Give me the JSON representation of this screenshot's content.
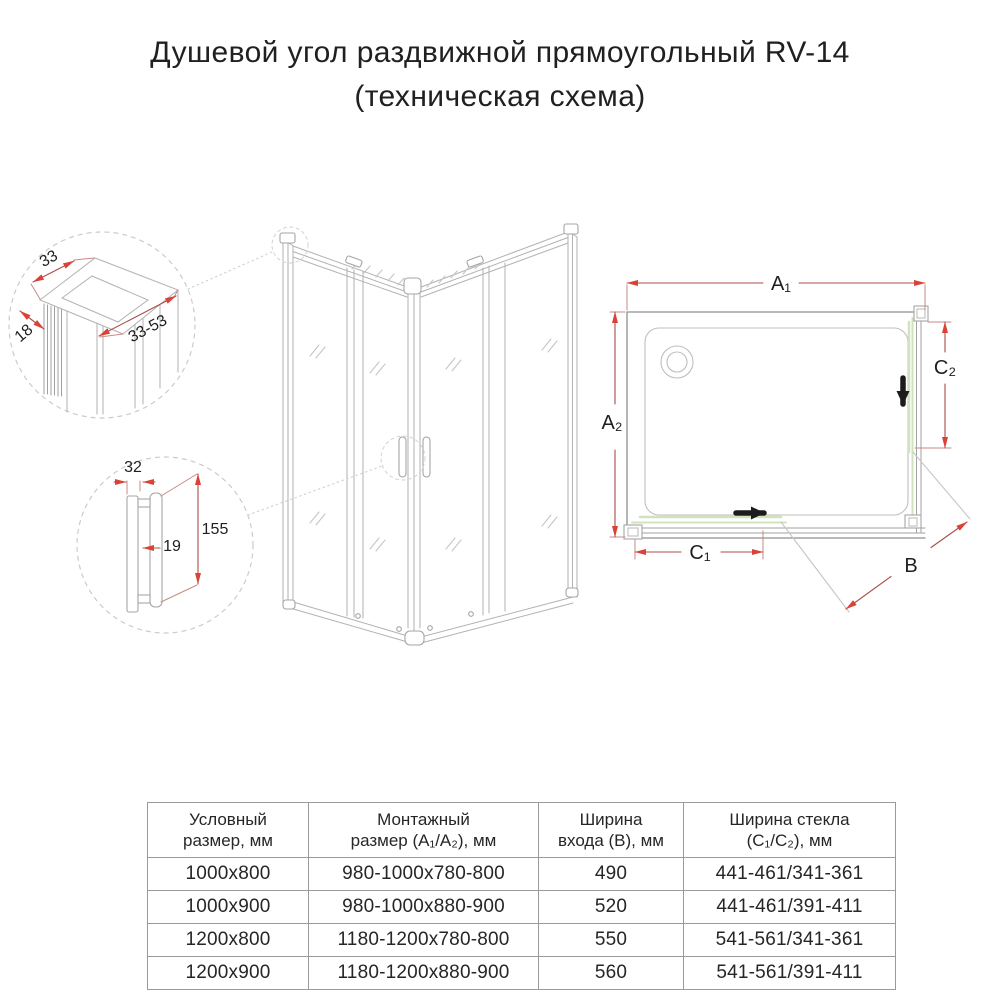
{
  "title": {
    "line1": "Душевой угол раздвижной прямоугольный RV-14",
    "line2": "(техническая схема)"
  },
  "diagram": {
    "profile_detail": {
      "width": "33",
      "depth": "18",
      "range": "33-53"
    },
    "handle_detail": {
      "depth": "32",
      "thickness": "19",
      "height": "155"
    },
    "plan": {
      "a1": "A₁",
      "a2": "A₂",
      "b": "B",
      "c1": "C₁",
      "c2": "C₂"
    },
    "colors": {
      "dimension_line": "#ab4d49",
      "dimension_arrow": "#da4237",
      "glass_green": "#cfe4bd",
      "drawing_gray": "#b2b2b2",
      "direction_arrow": "#1c1c1c"
    }
  },
  "table": {
    "headers": [
      {
        "line1": "Условный",
        "line2": "размер, мм"
      },
      {
        "line1": "Монтажный",
        "line2": "размер (A₁/A₂), мм"
      },
      {
        "line1": "Ширина",
        "line2": "входа (B), мм"
      },
      {
        "line1": "Ширина стекла",
        "line2": "(C₁/C₂), мм"
      }
    ],
    "rows": [
      [
        "1000x800",
        "980-1000x780-800",
        "490",
        "441-461/341-361"
      ],
      [
        "1000x900",
        "980-1000x880-900",
        "520",
        "441-461/391-411"
      ],
      [
        "1200x800",
        "1180-1200x780-800",
        "550",
        "541-561/341-361"
      ],
      [
        "1200x900",
        "1180-1200x880-900",
        "560",
        "541-561/391-411"
      ]
    ]
  }
}
